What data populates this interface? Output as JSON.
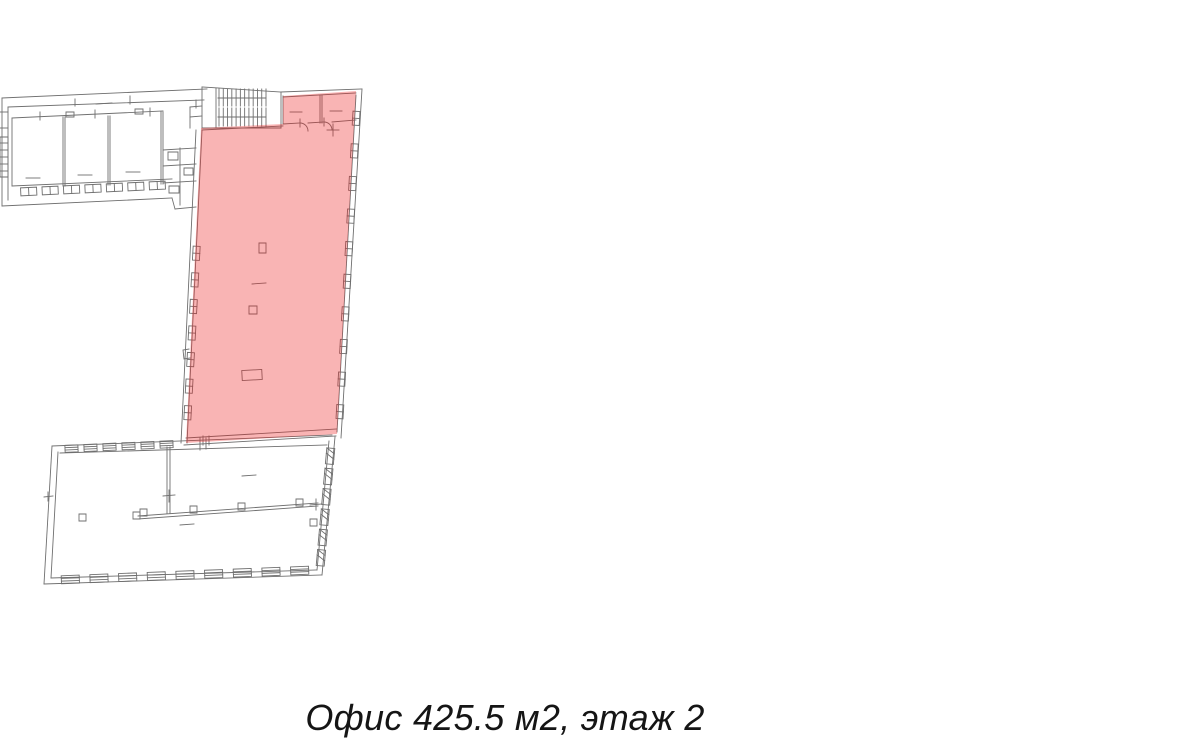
{
  "page": {
    "background_color": "#ffffff"
  },
  "floor_plan": {
    "line_color": "#6f6f6f",
    "highlight_color": "#ec2424",
    "highlight_opacity": "0.34"
  },
  "caption": {
    "text": "Офис 425.5 м2, этаж 2",
    "object_type": "Офис",
    "area_m2": "425.5",
    "floor": "2"
  }
}
